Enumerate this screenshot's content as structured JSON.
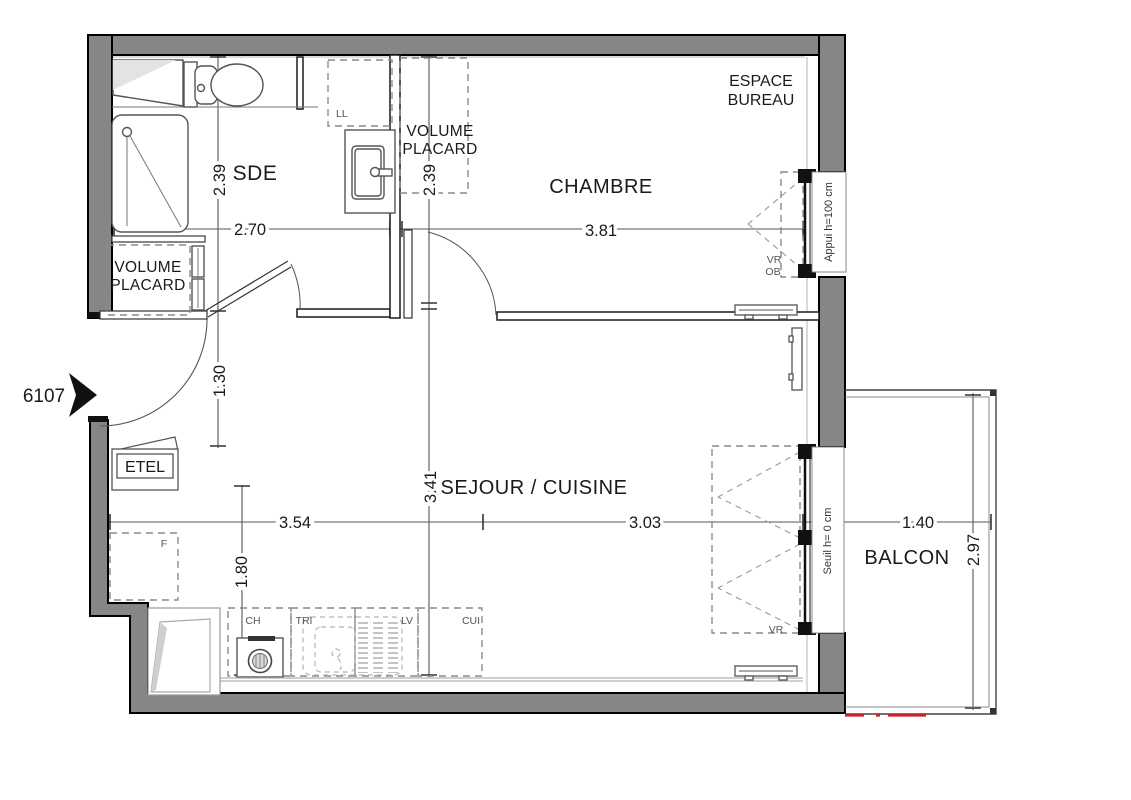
{
  "entry": {
    "unit_number": "6107"
  },
  "rooms": {
    "sde": "SDE",
    "chambre": "CHAMBRE",
    "espace_bureau_1": "ESPACE",
    "espace_bureau_2": "BUREAU",
    "sejour_cuisine": "SEJOUR / CUISINE",
    "balcon": "BALCON"
  },
  "closets": {
    "volume": "VOLUME",
    "placard": "PLACARD"
  },
  "equipment": {
    "etel": "ETEL",
    "ll": "LL",
    "f": "F",
    "ch": "CH",
    "tri": "TRI",
    "lv": "LV",
    "cui": "CUI",
    "vr": "VR",
    "ob": "OB"
  },
  "windows": {
    "chambre_sill": "Appui h=100 cm",
    "balcony_sill": "Seuil h= 0 cm"
  },
  "dimensions": {
    "sde_depth": "2.39",
    "sde_width": "2.70",
    "placard_depth": "2.39",
    "chambre_width": "3.81",
    "hall_width": "1.30",
    "sejour_depth": "3.41",
    "sejour_width_left": "3.54",
    "sejour_width_right": "3.03",
    "kitchen_depth": "1.80",
    "balcony_width": "1.40",
    "balcony_depth": "2.97"
  },
  "colors": {
    "wall_fill": "#868686",
    "marker_red": "#cc2127",
    "dash_gray": "#8a8a8a"
  }
}
